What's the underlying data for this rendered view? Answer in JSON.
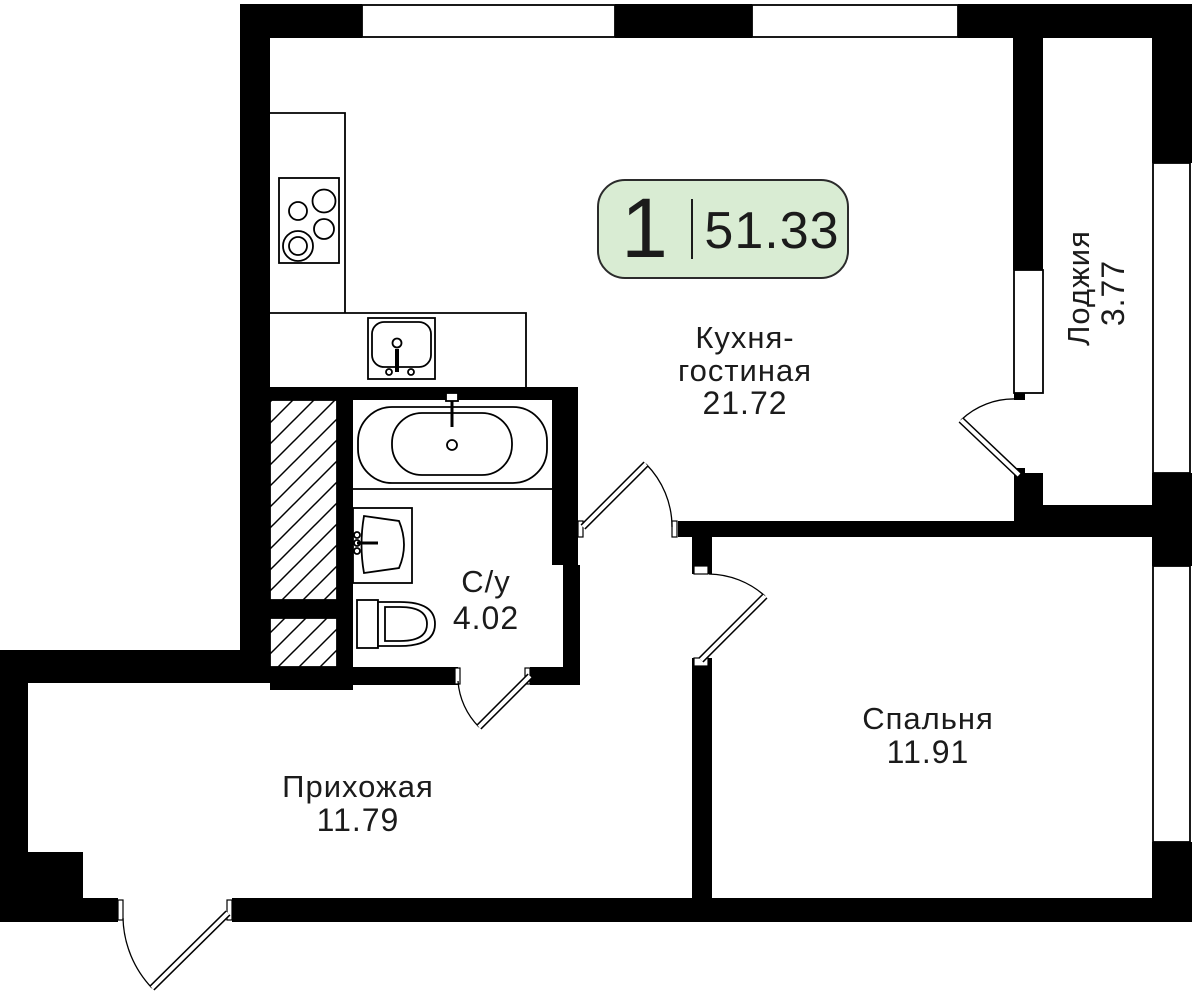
{
  "plan": {
    "badge": {
      "rooms_count": "1",
      "total_area": "51.33"
    },
    "rooms": {
      "kitchen_living": {
        "line1": "Кухня-",
        "line2": "гостиная",
        "area": "21.72"
      },
      "loggia": {
        "name": "Лоджия",
        "area": "3.77"
      },
      "bathroom": {
        "name": "С/у",
        "area": "4.02"
      },
      "hallway": {
        "name": "Прихожая",
        "area": "11.79"
      },
      "bedroom": {
        "name": "Спальня",
        "area": "11.91"
      }
    },
    "colors": {
      "badge_fill": "#d9ecd3",
      "badge_border": "#2b2b2b",
      "wall": "#000000",
      "background": "#ffffff"
    }
  }
}
